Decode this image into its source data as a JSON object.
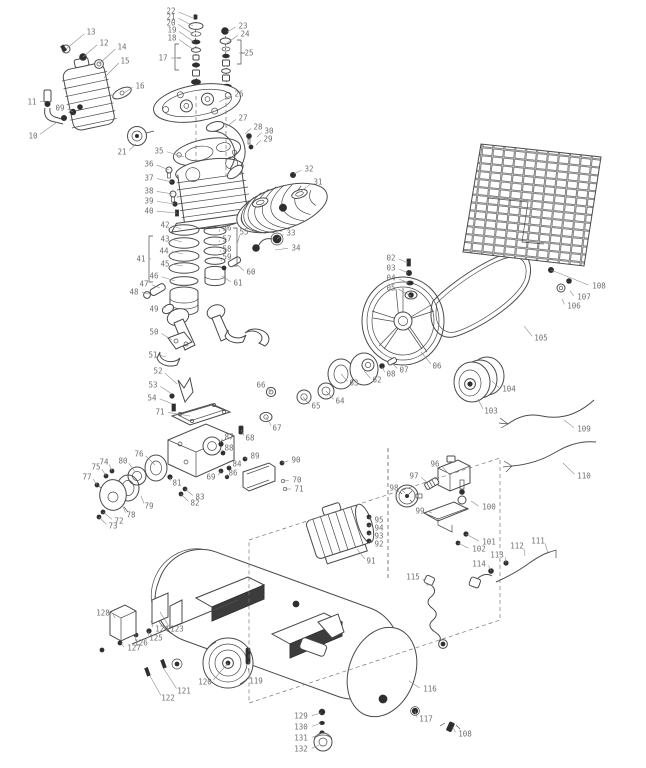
{
  "diagram": {
    "type": "exploded-parts-diagram",
    "subject": "belt-drive air compressor pump, flywheel, motor and tank assembly",
    "background_color": "#ffffff",
    "line_color": "#4a4a4a",
    "label_color": "#6e6e6e",
    "callouts": [
      {
        "n": "13",
        "x": 91,
        "y": 32,
        "tx": 66,
        "ty": 49
      },
      {
        "n": "12",
        "x": 104,
        "y": 43,
        "tx": 83,
        "ty": 57
      },
      {
        "n": "14",
        "x": 122,
        "y": 47,
        "tx": 99,
        "ty": 64
      },
      {
        "n": "15",
        "x": 125,
        "y": 61,
        "tx": 104,
        "ty": 78
      },
      {
        "n": "16",
        "x": 140,
        "y": 86,
        "tx": 124,
        "ty": 93
      },
      {
        "n": "11",
        "x": 32,
        "y": 102,
        "tx": 47,
        "ty": 101
      },
      {
        "n": "09",
        "x": 60,
        "y": 108,
        "tx": 73,
        "ty": 112
      },
      {
        "n": "10",
        "x": 33,
        "y": 136,
        "tx": 57,
        "ty": 122
      },
      {
        "n": "22",
        "x": 171,
        "y": 11,
        "tx": 193,
        "ty": 18
      },
      {
        "n": "21",
        "x": 171,
        "y": 17,
        "tx": 193,
        "ty": 26
      },
      {
        "n": "20",
        "x": 171,
        "y": 23,
        "tx": 193,
        "ty": 34
      },
      {
        "n": "19",
        "x": 172,
        "y": 30,
        "tx": 194,
        "ty": 42
      },
      {
        "n": "18",
        "x": 172,
        "y": 38,
        "tx": 194,
        "ty": 50
      },
      {
        "n": "17",
        "x": 163,
        "y": 58,
        "tx": 177,
        "ty": 58
      },
      {
        "n": "23",
        "x": 243,
        "y": 26,
        "tx": 227,
        "ty": 32
      },
      {
        "n": "24",
        "x": 245,
        "y": 34,
        "tx": 227,
        "ty": 43
      },
      {
        "n": "25",
        "x": 249,
        "y": 53,
        "tx": 239,
        "ty": 53
      },
      {
        "n": "26",
        "x": 239,
        "y": 94,
        "tx": 219,
        "ty": 102
      },
      {
        "n": "27",
        "x": 243,
        "y": 118,
        "tx": 226,
        "ty": 127
      },
      {
        "n": "28",
        "x": 258,
        "y": 127,
        "tx": 245,
        "ty": 134
      },
      {
        "n": "30",
        "x": 269,
        "y": 131,
        "tx": 257,
        "ty": 137
      },
      {
        "n": "29",
        "x": 268,
        "y": 139,
        "tx": 256,
        "ty": 145
      },
      {
        "n": "32",
        "x": 309,
        "y": 169,
        "tx": 294,
        "ty": 174
      },
      {
        "n": "31",
        "x": 318,
        "y": 182,
        "tx": 300,
        "ty": 192
      },
      {
        "n": "21",
        "x": 122,
        "y": 152,
        "tx": 136,
        "ty": 144
      },
      {
        "n": "35",
        "x": 159,
        "y": 151,
        "tx": 184,
        "ty": 157
      },
      {
        "n": "36",
        "x": 149,
        "y": 164,
        "tx": 169,
        "ty": 170
      },
      {
        "n": "37",
        "x": 149,
        "y": 178,
        "tx": 172,
        "ty": 182
      },
      {
        "n": "38",
        "x": 149,
        "y": 191,
        "tx": 173,
        "ty": 194
      },
      {
        "n": "39",
        "x": 149,
        "y": 201,
        "tx": 175,
        "ty": 204
      },
      {
        "n": "40",
        "x": 149,
        "y": 211,
        "tx": 177,
        "ty": 213
      },
      {
        "n": "33",
        "x": 291,
        "y": 233,
        "tx": 277,
        "ty": 239
      },
      {
        "n": "34",
        "x": 296,
        "y": 248,
        "tx": 275,
        "ty": 250
      },
      {
        "n": "56",
        "x": 227,
        "y": 228,
        "tx": 219,
        "ty": 232
      },
      {
        "n": "57",
        "x": 227,
        "y": 239,
        "tx": 220,
        "ty": 242
      },
      {
        "n": "58",
        "x": 227,
        "y": 249,
        "tx": 221,
        "ty": 252
      },
      {
        "n": "59",
        "x": 227,
        "y": 257,
        "tx": 222,
        "ty": 261
      },
      {
        "n": "55",
        "x": 244,
        "y": 232,
        "tx": 237,
        "ty": 244
      },
      {
        "n": "41",
        "x": 141,
        "y": 259,
        "tx": 151,
        "ty": 259
      },
      {
        "n": "42",
        "x": 165,
        "y": 225,
        "tx": 181,
        "ty": 229
      },
      {
        "n": "43",
        "x": 165,
        "y": 239,
        "tx": 182,
        "ty": 242
      },
      {
        "n": "44",
        "x": 164,
        "y": 251,
        "tx": 183,
        "ty": 254
      },
      {
        "n": "45",
        "x": 165,
        "y": 264,
        "tx": 183,
        "ty": 266
      },
      {
        "n": "46",
        "x": 154,
        "y": 276,
        "tx": 175,
        "ty": 281
      },
      {
        "n": "47",
        "x": 144,
        "y": 284,
        "tx": 160,
        "ty": 288
      },
      {
        "n": "48",
        "x": 134,
        "y": 292,
        "tx": 149,
        "ty": 294
      },
      {
        "n": "49",
        "x": 154,
        "y": 309,
        "tx": 166,
        "ty": 307
      },
      {
        "n": "60",
        "x": 251,
        "y": 272,
        "tx": 236,
        "ty": 264
      },
      {
        "n": "61",
        "x": 238,
        "y": 283,
        "tx": 222,
        "ty": 276
      },
      {
        "n": "50",
        "x": 154,
        "y": 332,
        "tx": 172,
        "ty": 340
      },
      {
        "n": "51",
        "x": 153,
        "y": 355,
        "tx": 166,
        "ty": 357
      },
      {
        "n": "52",
        "x": 158,
        "y": 371,
        "tx": 177,
        "ty": 384
      },
      {
        "n": "53",
        "x": 153,
        "y": 385,
        "tx": 172,
        "ty": 394
      },
      {
        "n": "54",
        "x": 152,
        "y": 398,
        "tx": 173,
        "ty": 404
      },
      {
        "n": "71",
        "x": 160,
        "y": 412,
        "tx": 190,
        "ty": 416
      },
      {
        "n": "66",
        "x": 261,
        "y": 385,
        "tx": 271,
        "ty": 392
      },
      {
        "n": "65",
        "x": 316,
        "y": 406,
        "tx": 303,
        "ty": 397
      },
      {
        "n": "67",
        "x": 277,
        "y": 428,
        "tx": 266,
        "ty": 417
      },
      {
        "n": "68",
        "x": 250,
        "y": 438,
        "tx": 241,
        "ty": 430
      },
      {
        "n": "87",
        "x": 229,
        "y": 437,
        "tx": 220,
        "ty": 443
      },
      {
        "n": "88",
        "x": 229,
        "y": 448,
        "tx": 222,
        "ty": 452
      },
      {
        "n": "89",
        "x": 255,
        "y": 456,
        "tx": 245,
        "ty": 459
      },
      {
        "n": "84",
        "x": 237,
        "y": 464,
        "tx": 229,
        "ty": 467
      },
      {
        "n": "86",
        "x": 233,
        "y": 473,
        "tx": 227,
        "ty": 477
      },
      {
        "n": "90",
        "x": 296,
        "y": 460,
        "tx": 282,
        "ty": 463
      },
      {
        "n": "70",
        "x": 297,
        "y": 480,
        "tx": 283,
        "ty": 481
      },
      {
        "n": "71",
        "x": 299,
        "y": 489,
        "tx": 285,
        "ty": 489
      },
      {
        "n": "69",
        "x": 211,
        "y": 477,
        "tx": 221,
        "ty": 471
      },
      {
        "n": "76",
        "x": 139,
        "y": 454,
        "tx": 155,
        "ty": 465
      },
      {
        "n": "74",
        "x": 104,
        "y": 462,
        "tx": 112,
        "ty": 471
      },
      {
        "n": "75",
        "x": 96,
        "y": 467,
        "tx": 106,
        "ty": 476
      },
      {
        "n": "80",
        "x": 123,
        "y": 461,
        "tx": 135,
        "ty": 472
      },
      {
        "n": "77",
        "x": 87,
        "y": 477,
        "tx": 97,
        "ty": 485
      },
      {
        "n": "79",
        "x": 149,
        "y": 506,
        "tx": 141,
        "ty": 496
      },
      {
        "n": "78",
        "x": 131,
        "y": 515,
        "tx": 122,
        "ty": 505
      },
      {
        "n": "72",
        "x": 119,
        "y": 521,
        "tx": 103,
        "ty": 512
      },
      {
        "n": "73",
        "x": 113,
        "y": 526,
        "tx": 99,
        "ty": 517
      },
      {
        "n": "81",
        "x": 177,
        "y": 483,
        "tx": 170,
        "ty": 477
      },
      {
        "n": "83",
        "x": 200,
        "y": 497,
        "tx": 185,
        "ty": 489
      },
      {
        "n": "82",
        "x": 195,
        "y": 503,
        "tx": 181,
        "ty": 494
      },
      {
        "n": "02",
        "x": 391,
        "y": 258,
        "tx": 408,
        "ty": 263
      },
      {
        "n": "03",
        "x": 391,
        "y": 268,
        "tx": 408,
        "ty": 273
      },
      {
        "n": "04",
        "x": 391,
        "y": 278,
        "tx": 409,
        "ty": 283
      },
      {
        "n": "05",
        "x": 391,
        "y": 288,
        "tx": 411,
        "ty": 296
      },
      {
        "n": "06",
        "x": 437,
        "y": 366,
        "tx": 421,
        "ty": 352
      },
      {
        "n": "07",
        "x": 404,
        "y": 370,
        "tx": 392,
        "ty": 363
      },
      {
        "n": "08",
        "x": 391,
        "y": 374,
        "tx": 382,
        "ty": 367
      },
      {
        "n": "62",
        "x": 377,
        "y": 380,
        "tx": 364,
        "ty": 371
      },
      {
        "n": "63",
        "x": 354,
        "y": 383,
        "tx": 341,
        "ty": 374
      },
      {
        "n": "64",
        "x": 340,
        "y": 401,
        "tx": 326,
        "ty": 391
      },
      {
        "n": "105",
        "x": 541,
        "y": 338,
        "tx": 524,
        "ty": 326
      },
      {
        "n": "106",
        "x": 574,
        "y": 306,
        "tx": 562,
        "ty": 299
      },
      {
        "n": "107",
        "x": 584,
        "y": 297,
        "tx": 570,
        "ty": 291
      },
      {
        "n": "108",
        "x": 599,
        "y": 286,
        "tx": 551,
        "ty": 270
      },
      {
        "n": "103",
        "x": 491,
        "y": 411,
        "tx": 478,
        "ty": 399
      },
      {
        "n": "104",
        "x": 509,
        "y": 389,
        "tx": 492,
        "ty": 381
      },
      {
        "n": "109",
        "x": 584,
        "y": 429,
        "tx": 564,
        "ty": 420
      },
      {
        "n": "110",
        "x": 584,
        "y": 476,
        "tx": 563,
        "ty": 463
      },
      {
        "n": "96",
        "x": 435,
        "y": 464,
        "tx": 447,
        "ty": 472
      },
      {
        "n": "97",
        "x": 414,
        "y": 476,
        "tx": 428,
        "ty": 483
      },
      {
        "n": "98",
        "x": 394,
        "y": 488,
        "tx": 405,
        "ty": 493
      },
      {
        "n": "99",
        "x": 420,
        "y": 511,
        "tx": 432,
        "ty": 513
      },
      {
        "n": "100",
        "x": 489,
        "y": 507,
        "tx": 471,
        "ty": 501
      },
      {
        "n": "101",
        "x": 489,
        "y": 542,
        "tx": 466,
        "ty": 534
      },
      {
        "n": "102",
        "x": 479,
        "y": 549,
        "tx": 458,
        "ty": 543
      },
      {
        "n": "95",
        "x": 379,
        "y": 520,
        "tx": 369,
        "ty": 517
      },
      {
        "n": "94",
        "x": 379,
        "y": 528,
        "tx": 369,
        "ty": 525
      },
      {
        "n": "93",
        "x": 379,
        "y": 536,
        "tx": 369,
        "ty": 533
      },
      {
        "n": "92",
        "x": 379,
        "y": 544,
        "tx": 369,
        "ty": 541
      },
      {
        "n": "91",
        "x": 371,
        "y": 561,
        "tx": 357,
        "ty": 549
      },
      {
        "n": "111",
        "x": 538,
        "y": 541,
        "tx": 548,
        "ty": 553
      },
      {
        "n": "112",
        "x": 517,
        "y": 546,
        "tx": 525,
        "ty": 556
      },
      {
        "n": "113",
        "x": 497,
        "y": 555,
        "tx": 506,
        "ty": 563
      },
      {
        "n": "114",
        "x": 479,
        "y": 564,
        "tx": 491,
        "ty": 571
      },
      {
        "n": "115",
        "x": 413,
        "y": 577,
        "tx": 428,
        "ty": 586
      },
      {
        "n": "128",
        "x": 103,
        "y": 613,
        "tx": 115,
        "ty": 618
      },
      {
        "n": "124",
        "x": 162,
        "y": 629,
        "tx": 151,
        "ty": 621
      },
      {
        "n": "123",
        "x": 177,
        "y": 629,
        "tx": 160,
        "ty": 612
      },
      {
        "n": "125",
        "x": 156,
        "y": 638,
        "tx": 149,
        "ty": 631
      },
      {
        "n": "126",
        "x": 141,
        "y": 643,
        "tx": 136,
        "ty": 635
      },
      {
        "n": "127",
        "x": 134,
        "y": 648,
        "tx": 121,
        "ty": 643
      },
      {
        "n": "119",
        "x": 256,
        "y": 681,
        "tx": 248,
        "ty": 668
      },
      {
        "n": "120",
        "x": 205,
        "y": 682,
        "tx": 228,
        "ty": 663
      },
      {
        "n": "121",
        "x": 184,
        "y": 691,
        "tx": 164,
        "ty": 669
      },
      {
        "n": "122",
        "x": 168,
        "y": 698,
        "tx": 150,
        "ty": 676
      },
      {
        "n": "116",
        "x": 430,
        "y": 689,
        "tx": 409,
        "ty": 681
      },
      {
        "n": "117",
        "x": 426,
        "y": 719,
        "tx": 415,
        "ty": 711
      },
      {
        "n": "108",
        "x": 465,
        "y": 734,
        "tx": 453,
        "ty": 727
      },
      {
        "n": "129",
        "x": 301,
        "y": 716,
        "tx": 321,
        "ty": 713
      },
      {
        "n": "130",
        "x": 301,
        "y": 727,
        "tx": 321,
        "ty": 723
      },
      {
        "n": "131",
        "x": 301,
        "y": 738,
        "tx": 321,
        "ty": 734
      },
      {
        "n": "132",
        "x": 301,
        "y": 749,
        "tx": 319,
        "ty": 745
      }
    ]
  }
}
